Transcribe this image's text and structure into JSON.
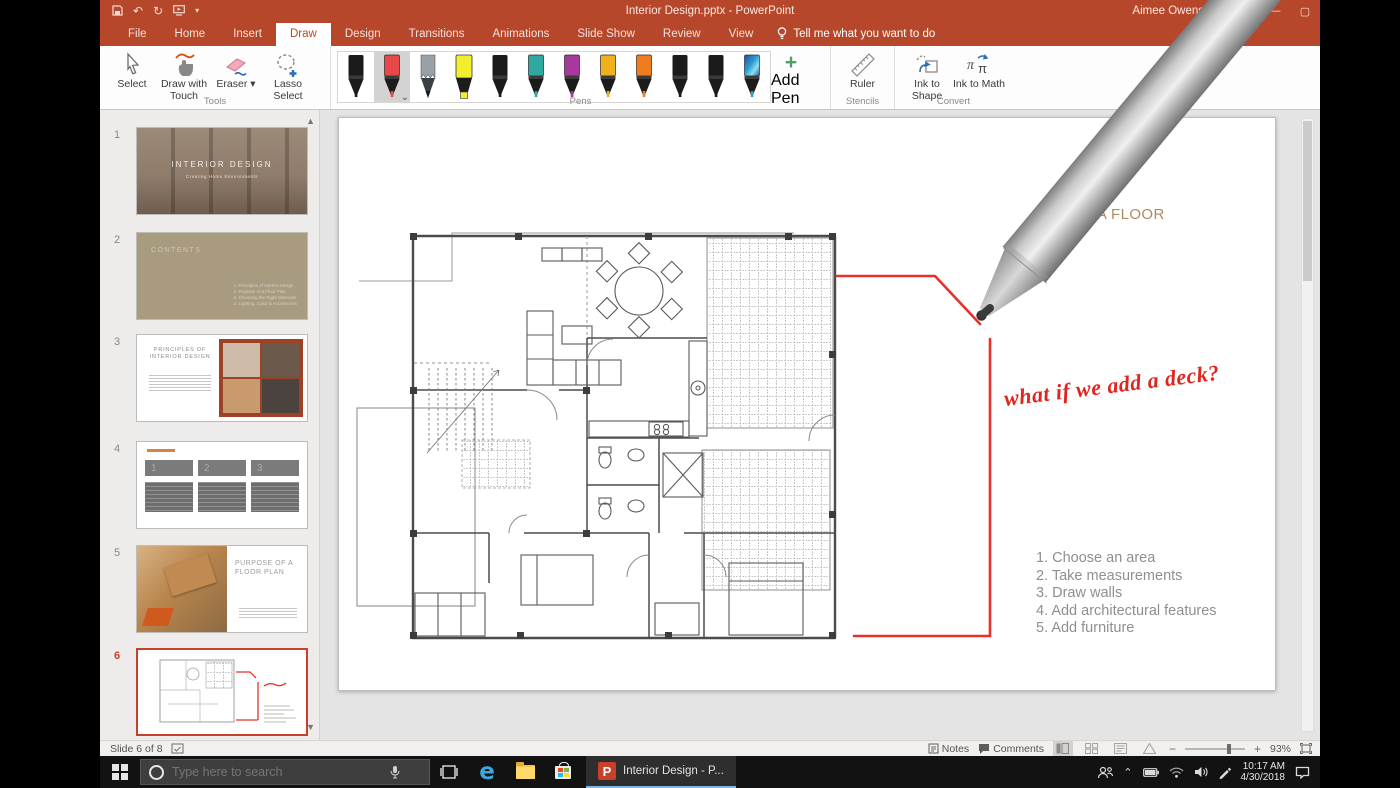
{
  "titlebar": {
    "title": "Interior Design.pptx - PowerPoint",
    "user": "Aimee Owens"
  },
  "tabs": [
    {
      "label": "File"
    },
    {
      "label": "Home"
    },
    {
      "label": "Insert"
    },
    {
      "label": "Draw"
    },
    {
      "label": "Design"
    },
    {
      "label": "Transitions"
    },
    {
      "label": "Animations"
    },
    {
      "label": "Slide Show"
    },
    {
      "label": "Review"
    },
    {
      "label": "View"
    }
  ],
  "tellme": "Tell me what you want to do",
  "ribbon": {
    "tools": {
      "label": "Tools",
      "select": "Select",
      "draw_with_touch": "Draw with Touch",
      "eraser": "Eraser",
      "lasso": "Lasso Select"
    },
    "pens": {
      "label": "Pens",
      "add_pen_line1": "Add",
      "add_pen_line2": "Pen",
      "items": [
        {
          "name": "black-marker-1",
          "type": "marker",
          "color": "#1b1b1b"
        },
        {
          "name": "red-pen",
          "type": "marker",
          "color": "#E8484A",
          "selected": true
        },
        {
          "name": "gray-pencil",
          "type": "pencil",
          "color": "#9AA1A6"
        },
        {
          "name": "yellow-highlighter",
          "type": "highlighter",
          "color": "#F5EE2E"
        },
        {
          "name": "black-marker-2",
          "type": "marker",
          "color": "#1b1b1b"
        },
        {
          "name": "teal-pen",
          "type": "marker",
          "color": "#2FA8A0"
        },
        {
          "name": "magenta-pen",
          "type": "marker",
          "color": "#A8379E"
        },
        {
          "name": "gold-pen",
          "type": "marker",
          "color": "#EFB21D"
        },
        {
          "name": "orange-pen",
          "type": "marker",
          "color": "#EF7D1F"
        },
        {
          "name": "black-effect-pen-1",
          "type": "marker",
          "color": "#1b1b1b"
        },
        {
          "name": "black-effect-pen-2",
          "type": "marker",
          "color": "#1b1b1b"
        },
        {
          "name": "galaxy-pen",
          "type": "galaxy",
          "color": "#2E9FD4"
        }
      ]
    },
    "stencils": {
      "label": "Stencils",
      "ruler": "Ruler"
    },
    "convert": {
      "label": "Convert",
      "ink_to_shape": "Ink to Shape",
      "ink_to_math": "Ink to Math"
    }
  },
  "thumbnails": [
    {
      "num": "1",
      "title": "INTERIOR DESIGN",
      "subtitle": "Creating Home Environments"
    },
    {
      "num": "2",
      "title": "CONTENTS",
      "items": [
        "1. Principles of Interior Design",
        "2. Purpose of a Floor Plan",
        "3. Choosing the Right Materials",
        "4. Lighting, Color & Accessories"
      ]
    },
    {
      "num": "3",
      "title": "PRINCIPLES OF INTERIOR DESIGN"
    },
    {
      "num": "4",
      "numbers": [
        "1",
        "2",
        "3"
      ]
    },
    {
      "num": "5",
      "title": "PURPOSE OF A FLOOR PLAN"
    },
    {
      "num": "6"
    }
  ],
  "slide": {
    "title": "CREATE A FLOOR PLAN",
    "ink_note": "what if we add a deck?",
    "steps": [
      "1. Choose an area",
      "2. Take measurements",
      "3. Draw walls",
      "4. Add architectural features",
      "5. Add furniture"
    ]
  },
  "statusbar": {
    "slide_indicator": "Slide 6 of 8",
    "notes": "Notes",
    "comments": "Comments",
    "zoom": "93%"
  },
  "taskbar": {
    "search_placeholder": "Type here to search",
    "app_label": "Interior Design - P...",
    "time": "10:17 AM",
    "date": "4/30/2018"
  },
  "colors": {
    "accent": "#B7472A",
    "ink_red": "#E8312A",
    "slide_title": "#B08A63",
    "task_underline": "#76B9ED"
  }
}
